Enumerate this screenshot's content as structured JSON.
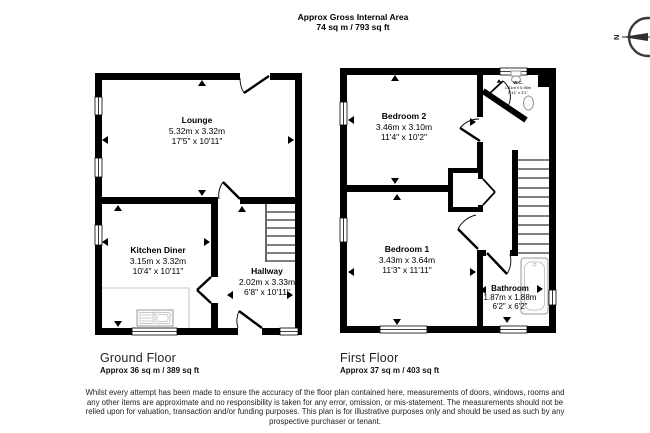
{
  "header": {
    "title_line1": "Approx Gross Internal Area",
    "title_line2": "74 sq m / 793 sq ft"
  },
  "compass": {
    "north_label": "N"
  },
  "floors": [
    {
      "name": "Ground Floor",
      "area": "Approx 36 sq m / 389 sq ft",
      "rooms": [
        {
          "name": "Lounge",
          "metric": "5.32m x 3.32m",
          "imperial": "17'5\" x 10'11\""
        },
        {
          "name": "Kitchen Diner",
          "metric": "3.15m x 3.32m",
          "imperial": "10'4\" x 10'11\""
        },
        {
          "name": "Hallway",
          "metric": "2.02m x 3.33m",
          "imperial": "6'8\" x 10'11\""
        }
      ]
    },
    {
      "name": "First Floor",
      "area": "Approx 37 sq m / 403 sq ft",
      "rooms": [
        {
          "name": "Bedroom 2",
          "metric": "3.46m x 3.10m",
          "imperial": "11'4\" x 10'2\""
        },
        {
          "name": "Bedroom 1",
          "metric": "3.43m x 3.64m",
          "imperial": "11'3\" x 11'11\""
        },
        {
          "name": "Bathroom",
          "metric": "1.87m x 1.88m",
          "imperial": "6'2\" x 6'2\""
        },
        {
          "name": "W.C.",
          "metric": "1.81m x 0.95m",
          "imperial": "5'11\" x 3'1\""
        }
      ]
    }
  ],
  "disclaimer": {
    "line1": "Whilst every attempt has been made to ensure the accuracy of the floor plan contained here, measurements of doors, windows, rooms and",
    "line2": "any other items are approximate and no responsibility is taken for any error, omission, or mis-statement. The measurements should not be",
    "line3": "relied upon for valuation, transaction and/or funding purposes. This plan is for illustrative purposes only and should be used as such by any",
    "line4": "prospective purchaser or tenant."
  }
}
